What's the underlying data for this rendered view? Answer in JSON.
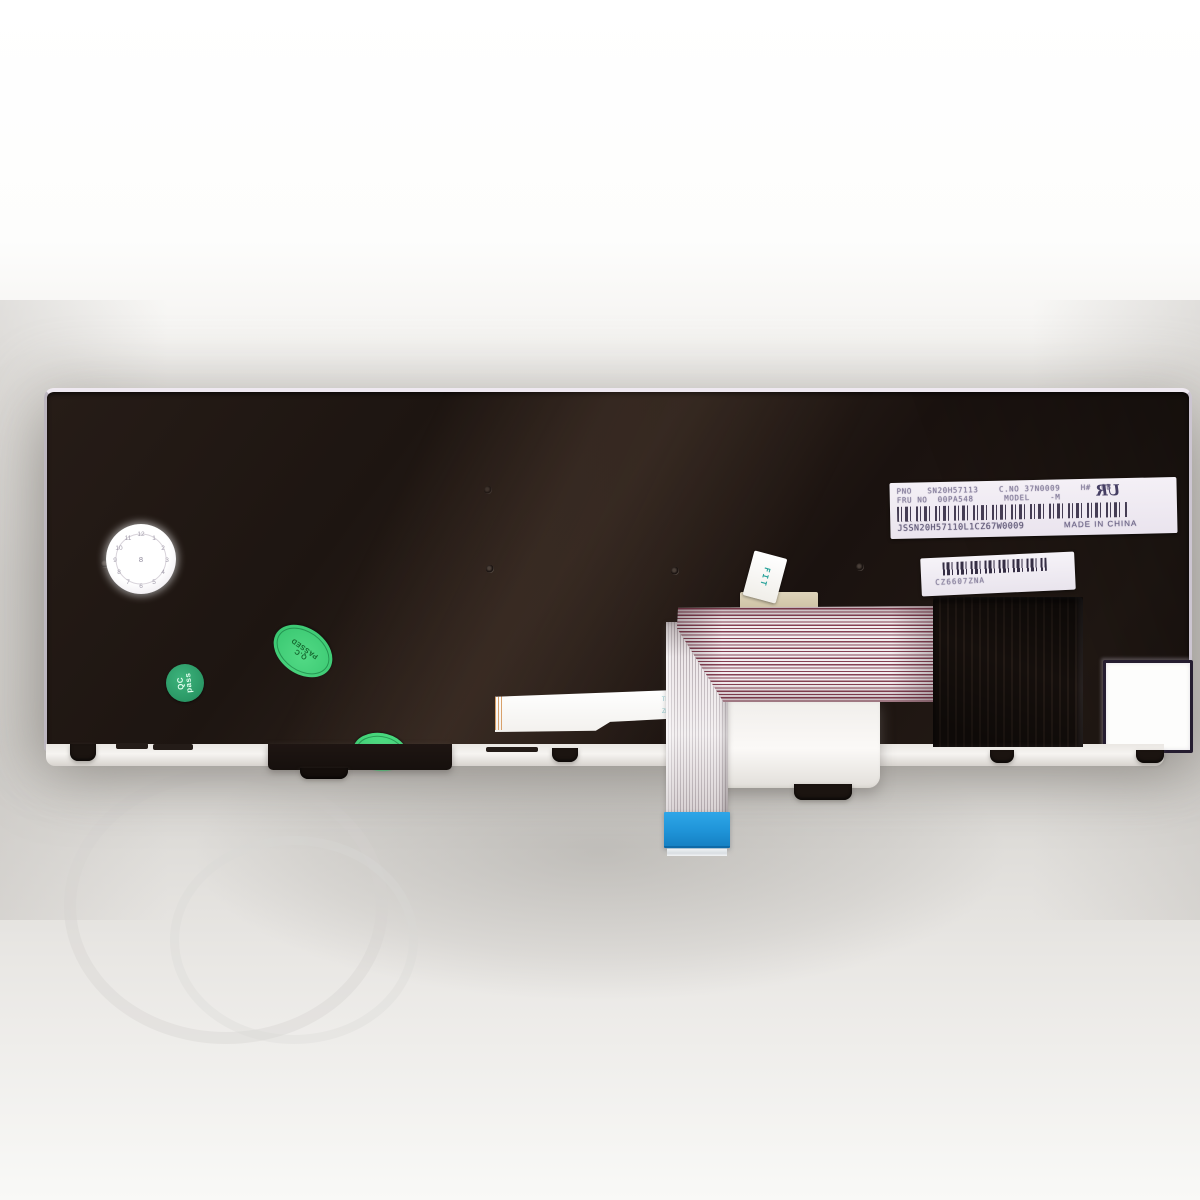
{
  "photo": {
    "description": "Rear view of a replacement laptop keyboard (dark bezel) with barcode labels, QC stickers and folded ribbon cable with blue connector",
    "main_label": {
      "line1": "PNO   SN20H57113    C.NO 37N0009    H#  0B",
      "line2": "FRU NO  00PA548      MODEL    -M",
      "serial": "JSSN20H57110L1CZ67W0009",
      "origin": "MADE IN CHINA",
      "cert_mark": "UR"
    },
    "serial_label": {
      "code": "CZ6607ZNA"
    },
    "qc_round_sticker": {
      "line1": "QC",
      "line2": "pass"
    },
    "qc_oval_sticker_1": {
      "line1": "Q.C",
      "line2": "PASSED"
    },
    "qc_oval_sticker_2": {
      "line1": "Q.C",
      "line2": "PASSED"
    },
    "fit_tab": {
      "text": "FIT"
    },
    "date_wheel": {
      "ticks": [
        "12",
        "1",
        "2",
        "3",
        "4",
        "5",
        "6",
        "7",
        "8",
        "9",
        "10",
        "11"
      ],
      "center": "8"
    },
    "cable_marks": {
      "m1": "TN",
      "m2": "ZM"
    },
    "colors": {
      "keyboard_body": "#1d1511",
      "qc_green_round": "#2a9765",
      "qc_green_oval": "#3ecf78",
      "connector_blue": "#1f94d8",
      "ribbon_stripe": "#864153",
      "label_bg": "#f4f0f6",
      "background": "#ffffff"
    }
  }
}
